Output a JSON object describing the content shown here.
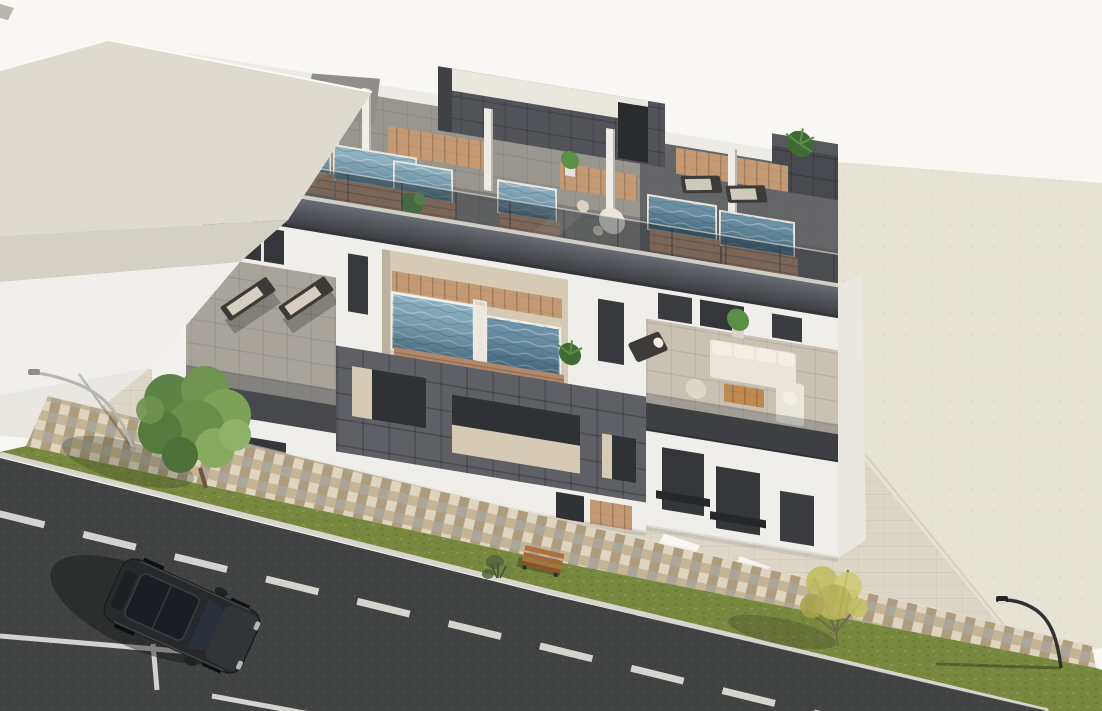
{
  "scene": {
    "type": "3d-architectural-render",
    "description": "Aerial 3D rendering of a modern three-storey apartment block with rooftop solarium plunge pools, glass railings, anthracite tile feature walls, first-floor pool terraces with outdoor furniture, front courtyard, mosaic paved sidewalk, lawn strip with trees and street lamps, asphalt road with lane markings and a parked dark SUV, neighbouring flat roof at upper left and an empty paved lot at right",
    "counts": {
      "rooftop_pools": 6,
      "terrace_pools": 2,
      "sun_loungers": 4,
      "sofa_sets": 1,
      "potted_plants": 8,
      "trees": 2,
      "street_lamps": 2,
      "benches": 1,
      "cars": 1
    }
  },
  "colors": {
    "sky": "#f8f7f4",
    "neighborRoof": "#dedad0",
    "neighborRoofShade": "#d4d0c5",
    "neighborWall": "#f0efeb",
    "neighborWallLower": "#e8e7e2",
    "lot": "#e6e2d4",
    "courtyard": "#dcd6c7",
    "mosaicBase": "#c8bba2",
    "grass": "#79883f",
    "road": "#414242",
    "curb": "#d7d5cd",
    "marking": "#e9e8e3",
    "buildingWhite": "#efeeea",
    "recessBeige": "#d5cab4",
    "fasciaDark": "#3d3f43",
    "glassTint": "#2e353c",
    "gridWall": "#5e6065",
    "bulkheadDark": "#515358",
    "deckLight": "#98968f",
    "deckDark": "#5e5f62",
    "terraceFloor": "#a8a49c",
    "rightFloor": "#c9c2b3",
    "waterLight": "#7ba6bb",
    "waterMid": "#6f9cb2",
    "waterDeep": "#4e7b95",
    "poolBrick": "#b2886a",
    "woodDeck": "#c49a74",
    "plantGreen": "#5a8f46",
    "palmGreen": "#3f6b33",
    "treeGreen": "#699049",
    "treeYellow": "#c2bd62",
    "furnitureCream": "#e9e5da",
    "furnitureDark": "#3c3b38",
    "tableWood": "#bf8a50",
    "carBody": "#27292c",
    "carGlass": "#1a1e24",
    "benchWood": "#b06f3e",
    "lampLight": "#b7b5b0",
    "lampDark": "#2f3133"
  }
}
